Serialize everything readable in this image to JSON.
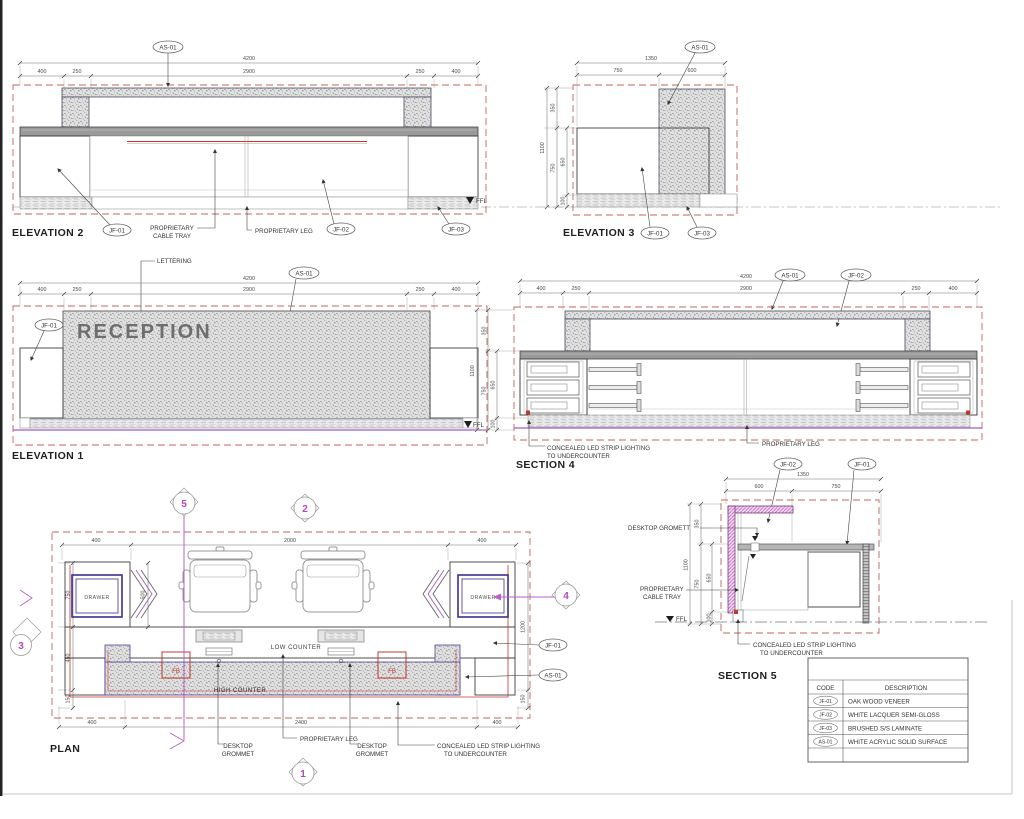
{
  "sheet": {
    "background": "#ffffff",
    "colors": {
      "dashed_box": "#c0645a",
      "accent_red": "#c0392b",
      "magenta": "#b845b8",
      "violet_line": "#a45ec4",
      "indigo": "#3d2f8f",
      "counter_gray": "#9a9a9a",
      "ink": "#3a3a3a"
    }
  },
  "titles": {
    "elevation2": "ELEVATION 2",
    "elevation3": "ELEVATION 3",
    "elevation1": "ELEVATION 1",
    "section4": "SECTION 4",
    "section5": "SECTION 5",
    "plan": "PLAN"
  },
  "callouts": {
    "as01": "AS-01",
    "jf01": "JF-01",
    "jf02": "JF-02",
    "jf03": "JF-03"
  },
  "labels": {
    "lettering": "LETTERING",
    "reception": "RECEPTION",
    "ffl": "FFL",
    "proprietary": "PROPRIETARY",
    "cable_tray": "CABLE TRAY",
    "proprietary_leg": "PROPRIETARY LEG",
    "led_line1": "CONCEALED LED STRIP LIGHTING",
    "led_line2": "TO UNDERCOUNTER",
    "desktop": "DESKTOP",
    "grommet": "GROMMET",
    "desktop_gromett": "DESKTOP GROMETT",
    "drawer": "DRAWER",
    "low_counter": "LOW COUNTER",
    "high_counter": "HIGH COUNTER",
    "fb": "FB"
  },
  "dims": {
    "long_total": "4200",
    "long_segs": [
      "400",
      "250",
      "2900",
      "250",
      "400"
    ],
    "e3_total": "1350",
    "e3_segs": [
      "750",
      "600"
    ],
    "s5_total": "1350",
    "s5_segs": [
      "600",
      "750"
    ],
    "v_total": "1100",
    "v_seg_top": "350",
    "v_seg_mid": "750",
    "v_seg_body": "650",
    "v_seg_base": "100",
    "plan_top": [
      "400",
      "2000",
      "400"
    ],
    "plan_bottom": [
      "400",
      "2400",
      "400"
    ],
    "plan_left": [
      "750",
      "450",
      "150"
    ],
    "plan_right": [
      "1200",
      "150"
    ],
    "plan_drawer_travel": "500"
  },
  "markers": {
    "m1": "1",
    "m2": "2",
    "m3": "3",
    "m4": "4",
    "m5": "5"
  },
  "table": {
    "headers": [
      "CODE",
      "DESCRIPTION"
    ],
    "rows": [
      {
        "code": "JF-01",
        "desc": "OAK WOOD VENEER"
      },
      {
        "code": "JF-02",
        "desc": "WHITE LACQUER SEMI-GLOSS"
      },
      {
        "code": "JF-03",
        "desc": "BRUSHED S/S LAMINATE"
      },
      {
        "code": "AS-01",
        "desc": "WHITE ACRYLIC SOLID SURFACE"
      }
    ]
  }
}
